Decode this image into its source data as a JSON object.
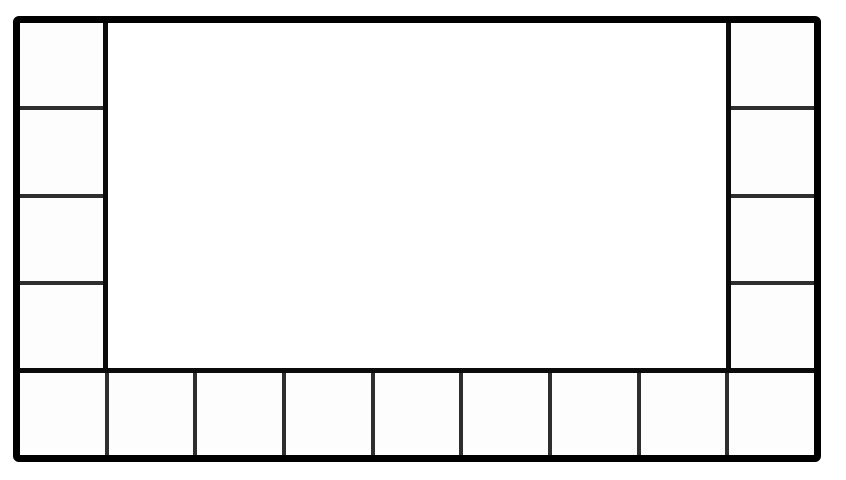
{
  "meta": {
    "description": "Black-and-white board layout diagram: a thick-bordered rectangle with a column of empty squares on the left edge, a column on the right edge, a row of empty squares along the bottom edge, and a large empty central panel that extends to the top border. No text or labels.",
    "canvas": {
      "width": 846,
      "height": 480,
      "background": "#ffffff"
    }
  },
  "diagram": {
    "board": {
      "x": 13,
      "y": 16,
      "width": 808,
      "height": 446,
      "outer_border": {
        "color": "#000000",
        "width": 7,
        "radius": 6
      },
      "heavy_line": {
        "color": "#0b0b0b",
        "width": 5
      },
      "divider": {
        "color": "#2e2e2e",
        "width": 4
      },
      "cell_fill": "#fdfdfd",
      "center_fill": "#ffffff",
      "side_column_width": 88,
      "bottom_row_height": 87,
      "left_column_cell_count": 4,
      "right_column_cell_count": 4,
      "bottom_row_cell_count": 9,
      "top_row_cell_count": 0
    }
  }
}
